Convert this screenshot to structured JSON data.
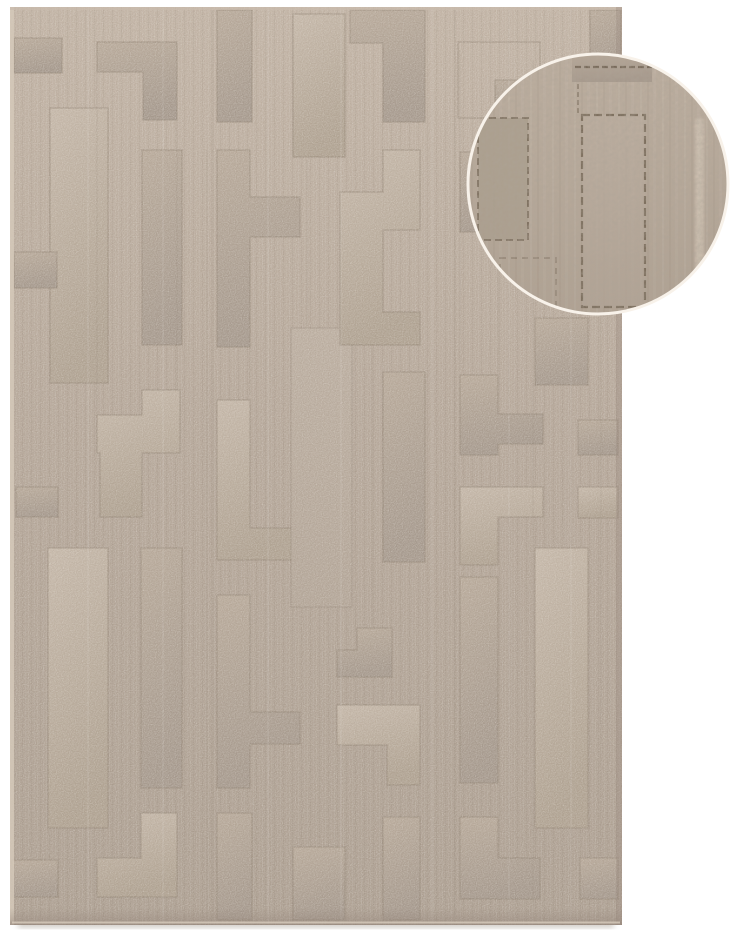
{
  "subject": "Product photo of a beige embossed rug with a geometric maze pattern and a circular magnified texture detail inset",
  "canvas": {
    "width": 740,
    "height": 940,
    "background": "#ffffff"
  },
  "colors": {
    "background": "#ffffff",
    "rug_top": "#c1b2a3",
    "rug_mid": "#b4a597",
    "rug_bottom": "#aa9c8e",
    "groove": "#8a7c6c",
    "sheen_light_hi": "#c7b9aa",
    "sheen_light_lo": "#aea08f",
    "sheen_mid_hi": "#b8a999",
    "sheen_mid_lo": "#a3968a",
    "subtle_hi": "#bcaea0",
    "subtle_lo": "#b2a496",
    "selvedge": "#d5c9ba",
    "edge_dark": "#94USED",
    "edge_dark_fix": "#94857a",
    "shadow": "#9d9488",
    "streak_light": "#ffffff",
    "inset_ground_hi": "#bdafa0",
    "inset_ground_lo": "#b0a293",
    "inset_groove": "#6e604f",
    "inset_square": "#ab9e8e",
    "inset_streak": "#dbcfbf",
    "ring": "#f8f2ea"
  },
  "rug": {
    "rect": [
      10,
      7,
      612,
      918
    ],
    "shapes": [
      {
        "t": "rect",
        "xywh": [
          14,
          38,
          48,
          35
        ],
        "tone": "mid"
      },
      {
        "t": "rect",
        "xywh": [
          50,
          108,
          58,
          275
        ],
        "tone": "light"
      },
      {
        "t": "rect",
        "xywh": [
          14,
          252,
          43,
          36
        ],
        "tone": "mid"
      },
      {
        "t": "rect",
        "xywh": [
          16,
          487,
          42,
          30
        ],
        "tone": "mid"
      },
      {
        "t": "rect",
        "xywh": [
          48,
          548,
          60,
          280
        ],
        "tone": "light"
      },
      {
        "t": "rect",
        "xywh": [
          12,
          860,
          46,
          37
        ],
        "tone": "mid"
      },
      {
        "t": "poly",
        "pts": "97,42 177,42 177,120 143,120 143,72 97,72",
        "tone": "mid"
      },
      {
        "t": "rect",
        "xywh": [
          142,
          150,
          40,
          195
        ],
        "tone": "mid"
      },
      {
        "t": "poly",
        "pts": "97,415 142,415 142,390 180,390 180,453 142,453 142,517 100,517 100,453 97,453",
        "tone": "light"
      },
      {
        "t": "rect",
        "xywh": [
          141,
          548,
          41,
          240
        ],
        "tone": "mid"
      },
      {
        "t": "poly",
        "pts": "141,813 177,813 177,897 97,897 97,858 141,858",
        "tone": "light"
      },
      {
        "t": "rect",
        "xywh": [
          217,
          10,
          35,
          112
        ],
        "tone": "mid"
      },
      {
        "t": "poly",
        "pts": "217,150 250,150 250,197 300,197 300,237 250,237 250,347 217,347",
        "tone": "mid"
      },
      {
        "t": "poly",
        "pts": "217,400 250,400 250,528 297,528 297,560 217,560",
        "tone": "light"
      },
      {
        "t": "poly",
        "pts": "217,595 250,595 250,712 300,712 300,744 250,744 250,788 217,788",
        "tone": "mid"
      },
      {
        "t": "rect",
        "xywh": [
          217,
          813,
          35,
          107
        ],
        "tone": "mid"
      },
      {
        "t": "rect",
        "xywh": [
          293,
          14,
          52,
          143
        ],
        "tone": "light"
      },
      {
        "t": "rect",
        "xywh": [
          291,
          328,
          61,
          279
        ],
        "tone": "subtle"
      },
      {
        "t": "rect",
        "xywh": [
          293,
          847,
          52,
          73
        ],
        "tone": "mid"
      },
      {
        "t": "poly",
        "pts": "350,10 425,10 425,122 383,122 383,43 350,43",
        "tone": "mid"
      },
      {
        "t": "poly",
        "pts": "340,192 383,192 383,150 420,150 420,230 383,230 383,312 420,312 420,345 340,345",
        "tone": "light"
      },
      {
        "t": "rect",
        "xywh": [
          383,
          372,
          42,
          190
        ],
        "tone": "mid"
      },
      {
        "t": "poly",
        "pts": "357,628 392,628 392,677 337,677 337,650 357,650",
        "tone": "mid"
      },
      {
        "t": "poly",
        "pts": "337,705 420,705 420,785 387,785 387,745 337,745",
        "tone": "light"
      },
      {
        "t": "rect",
        "xywh": [
          383,
          817,
          37,
          103
        ],
        "tone": "mid"
      },
      {
        "t": "rect",
        "xywh": [
          458,
          42,
          82,
          76
        ],
        "tone": "outline"
      },
      {
        "t": "rect",
        "xywh": [
          495,
          80,
          45,
          38
        ],
        "tone": "mid"
      },
      {
        "t": "rect",
        "xywh": [
          460,
          152,
          38,
          80
        ],
        "tone": "mid"
      },
      {
        "t": "poly",
        "pts": "460,375 498,375 498,414 543,414 543,444 498,444 498,455 460,455",
        "tone": "mid"
      },
      {
        "t": "poly",
        "pts": "460,487 543,487 543,517 498,517 498,565 460,565",
        "tone": "light"
      },
      {
        "t": "rect",
        "xywh": [
          460,
          577,
          38,
          206
        ],
        "tone": "mid"
      },
      {
        "t": "poly",
        "pts": "460,817 498,817 498,858 540,858 540,899 460,899",
        "tone": "mid"
      },
      {
        "t": "rect",
        "xywh": [
          590,
          10,
          31,
          68
        ],
        "tone": "mid"
      },
      {
        "t": "rect",
        "xywh": [
          535,
          318,
          53,
          67
        ],
        "tone": "mid"
      },
      {
        "t": "rect",
        "xywh": [
          578,
          420,
          40,
          35
        ],
        "tone": "mid"
      },
      {
        "t": "rect",
        "xywh": [
          578,
          487,
          40,
          31
        ],
        "tone": "light"
      },
      {
        "t": "rect",
        "xywh": [
          535,
          548,
          53,
          280
        ],
        "tone": "light"
      },
      {
        "t": "rect",
        "xywh": [
          580,
          858,
          38,
          41
        ],
        "tone": "mid"
      }
    ],
    "grooves": [
      [
        213,
        10,
        213,
        918
      ],
      [
        207,
        150,
        207,
        918
      ],
      [
        455,
        10,
        455,
        918
      ],
      [
        533,
        60,
        533,
        905
      ],
      [
        601,
        80,
        601,
        858
      ],
      [
        307,
        160,
        307,
        326
      ],
      [
        372,
        348,
        372,
        625
      ],
      [
        97,
        73,
        97,
        414
      ],
      [
        177,
        122,
        177,
        390
      ],
      [
        250,
        240,
        250,
        395
      ],
      [
        498,
        232,
        498,
        372
      ],
      [
        460,
        50,
        460,
        370
      ]
    ],
    "streaks": [
      88,
      163,
      268,
      341,
      432,
      509,
      571
    ]
  },
  "inset": {
    "cx": 598,
    "cy": 184,
    "r": 130,
    "ring_width": 3,
    "top_bar": [
      572,
      52,
      80,
      30
    ],
    "dash_top": [
      575,
      67,
      652,
      67
    ],
    "left_square": [
      478,
      118,
      50,
      122
    ],
    "tall_rect": [
      582,
      115,
      63,
      192
    ],
    "streak": [
      695,
      118,
      9,
      190
    ],
    "vline": [
      578,
      84,
      578,
      115
    ],
    "sub_outline": [
      500,
      258,
      56,
      60
    ]
  }
}
